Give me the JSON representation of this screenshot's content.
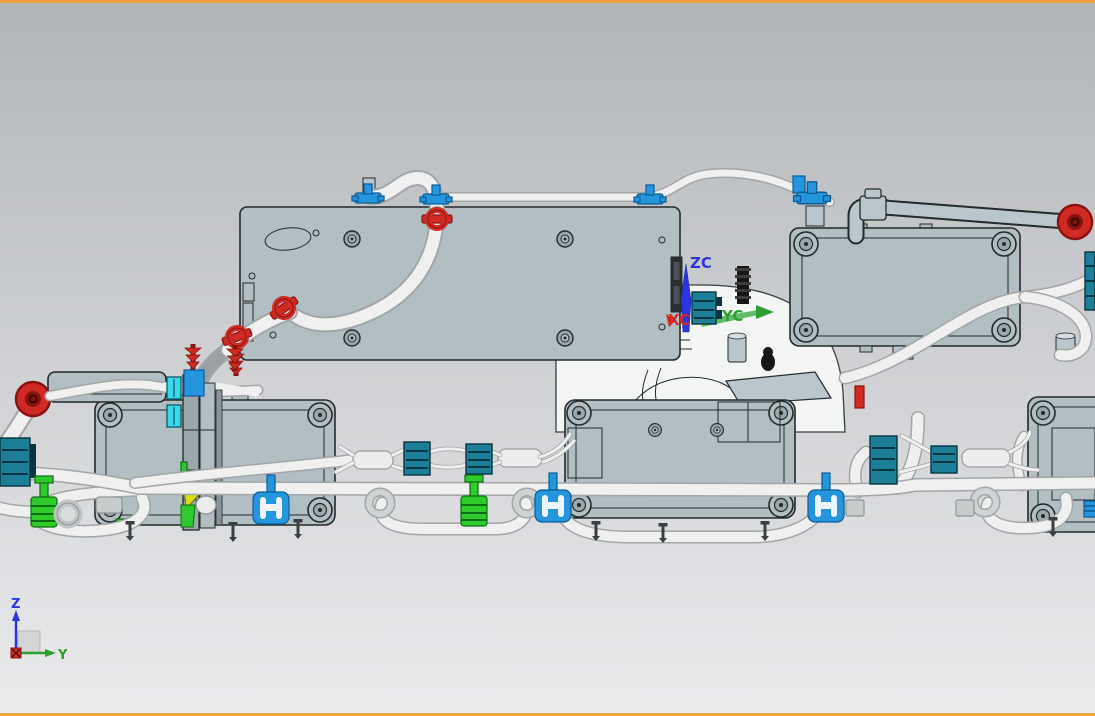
{
  "viewport": {
    "description": "CAD 3D viewport, side view of cable/hose harness assembly with mounted controller boxes",
    "view_orientation": "Z up, Y right"
  },
  "wcs_triad": {
    "z_label": "ZC",
    "y_label": "YC",
    "x_label": "XC"
  },
  "view_triad": {
    "z_label": "Z",
    "y_label": "Y"
  },
  "colors": {
    "border_orange": "#efa03f",
    "bg_top": "#b2b5b8",
    "bg_bottom": "#eaebed",
    "panel": "#b1bec2",
    "panel_dark": "#9aa7ab",
    "ink": "#24292b",
    "tube": "#f0f0f0",
    "tube_edge": "#a2a6a8",
    "gray_pipe": "#b9c6cb",
    "red": "#cf2b24",
    "dark_red": "#871410",
    "blue": "#2596dd",
    "blue_dark": "#0b5c94",
    "cyan": "#3bd9e8",
    "teal": "#1d7e98",
    "teal_dark": "#073540",
    "green": "#2fca2b",
    "green_dark": "#0c6e14",
    "yellow": "#d9e018",
    "axis_blue": "#2b35e0",
    "axis_green": "#2da12d",
    "axis_red": "#d42a24",
    "black_part": "#161616",
    "white_body": "#f4f5f5"
  },
  "components": [
    "top-cover-panel",
    "right-controller-box",
    "left-controller-box",
    "middle-controller-box",
    "lower-right-controller-box",
    "white-body-shell",
    "harness-main-tube",
    "coolant-pipe",
    "red-grommet-right",
    "red-grommet-left",
    "red-pipe-clamps",
    "blue-tube-clips",
    "blue-p-clamps",
    "teal-connectors",
    "green-connectors",
    "cyan-clips",
    "push-pins",
    "mounting-bracket",
    "corrugated-stud",
    "wcs-triad",
    "view-orientation-triad"
  ]
}
